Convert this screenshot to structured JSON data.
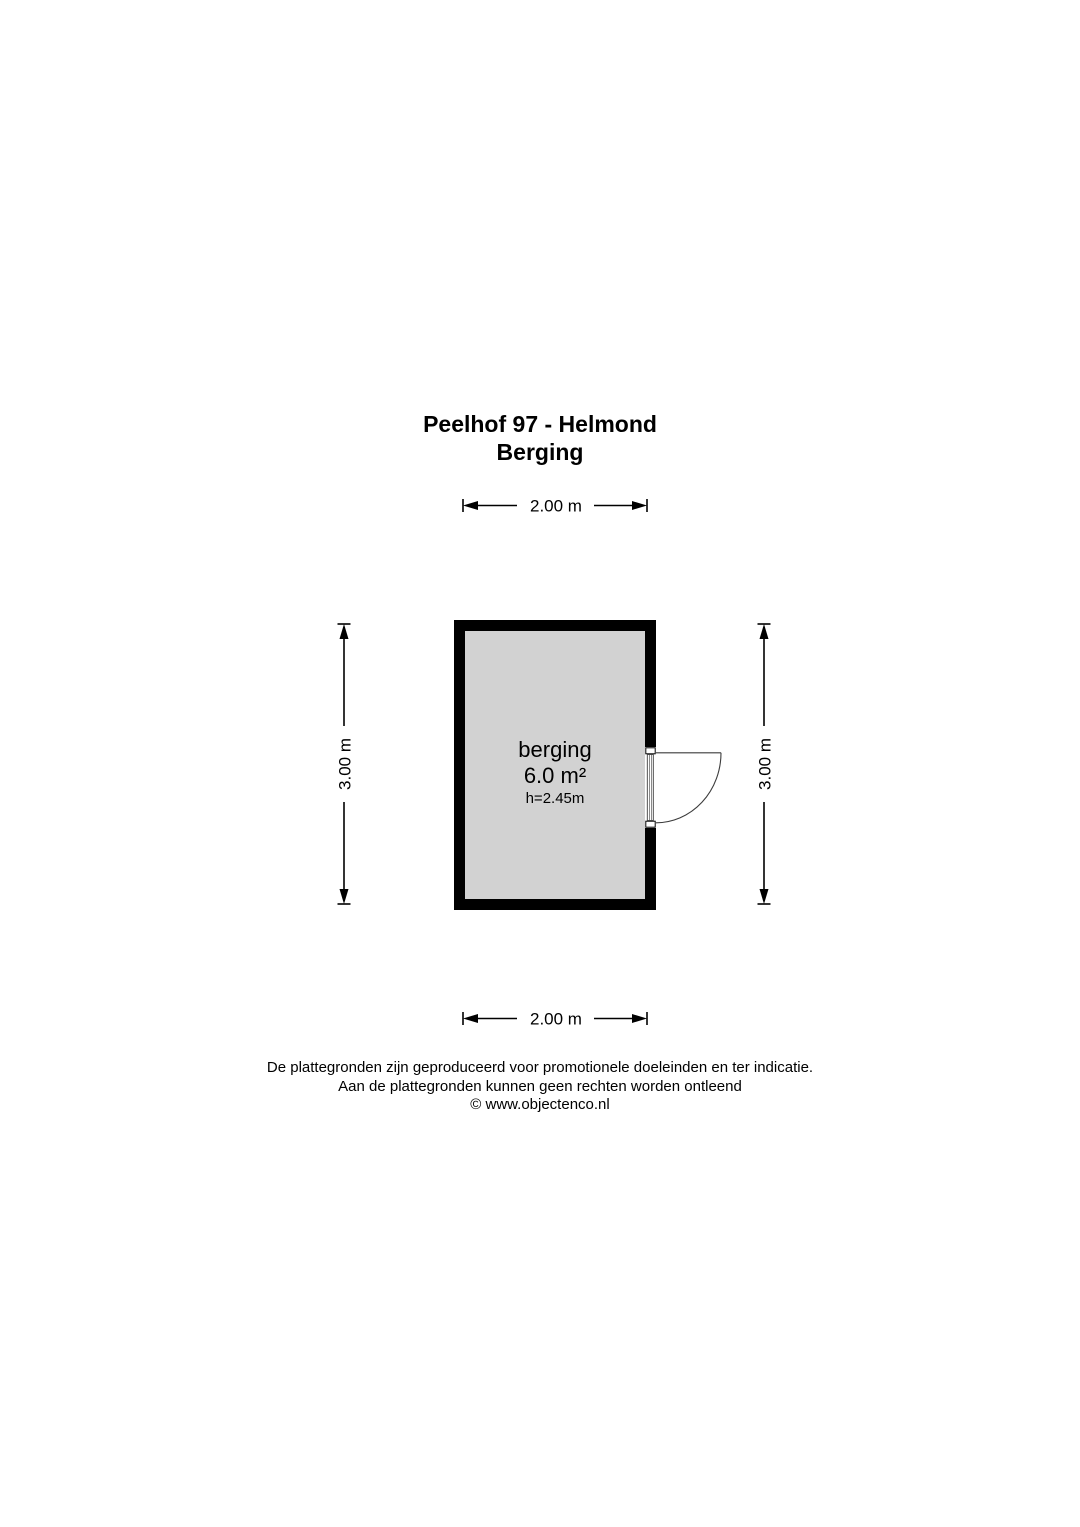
{
  "title": {
    "line1": "Peelhof 97 - Helmond",
    "line2": "Berging"
  },
  "room": {
    "name": "berging",
    "area": "6.0 m²",
    "ceiling_height": "h=2.45m",
    "floor_color": "#d2d2d2",
    "wall_color": "#000000"
  },
  "dimensions": {
    "top_width": "2.00 m",
    "bottom_width": "2.00 m",
    "left_height": "3.00 m",
    "right_height": "3.00 m"
  },
  "footer": {
    "line1": "De plattegronden zijn geproduceerd voor promotionele doeleinden en ter indicatie.",
    "line2": "Aan de plattegronden kunnen geen rechten worden ontleend",
    "line3": "© www.objectenco.nl"
  }
}
